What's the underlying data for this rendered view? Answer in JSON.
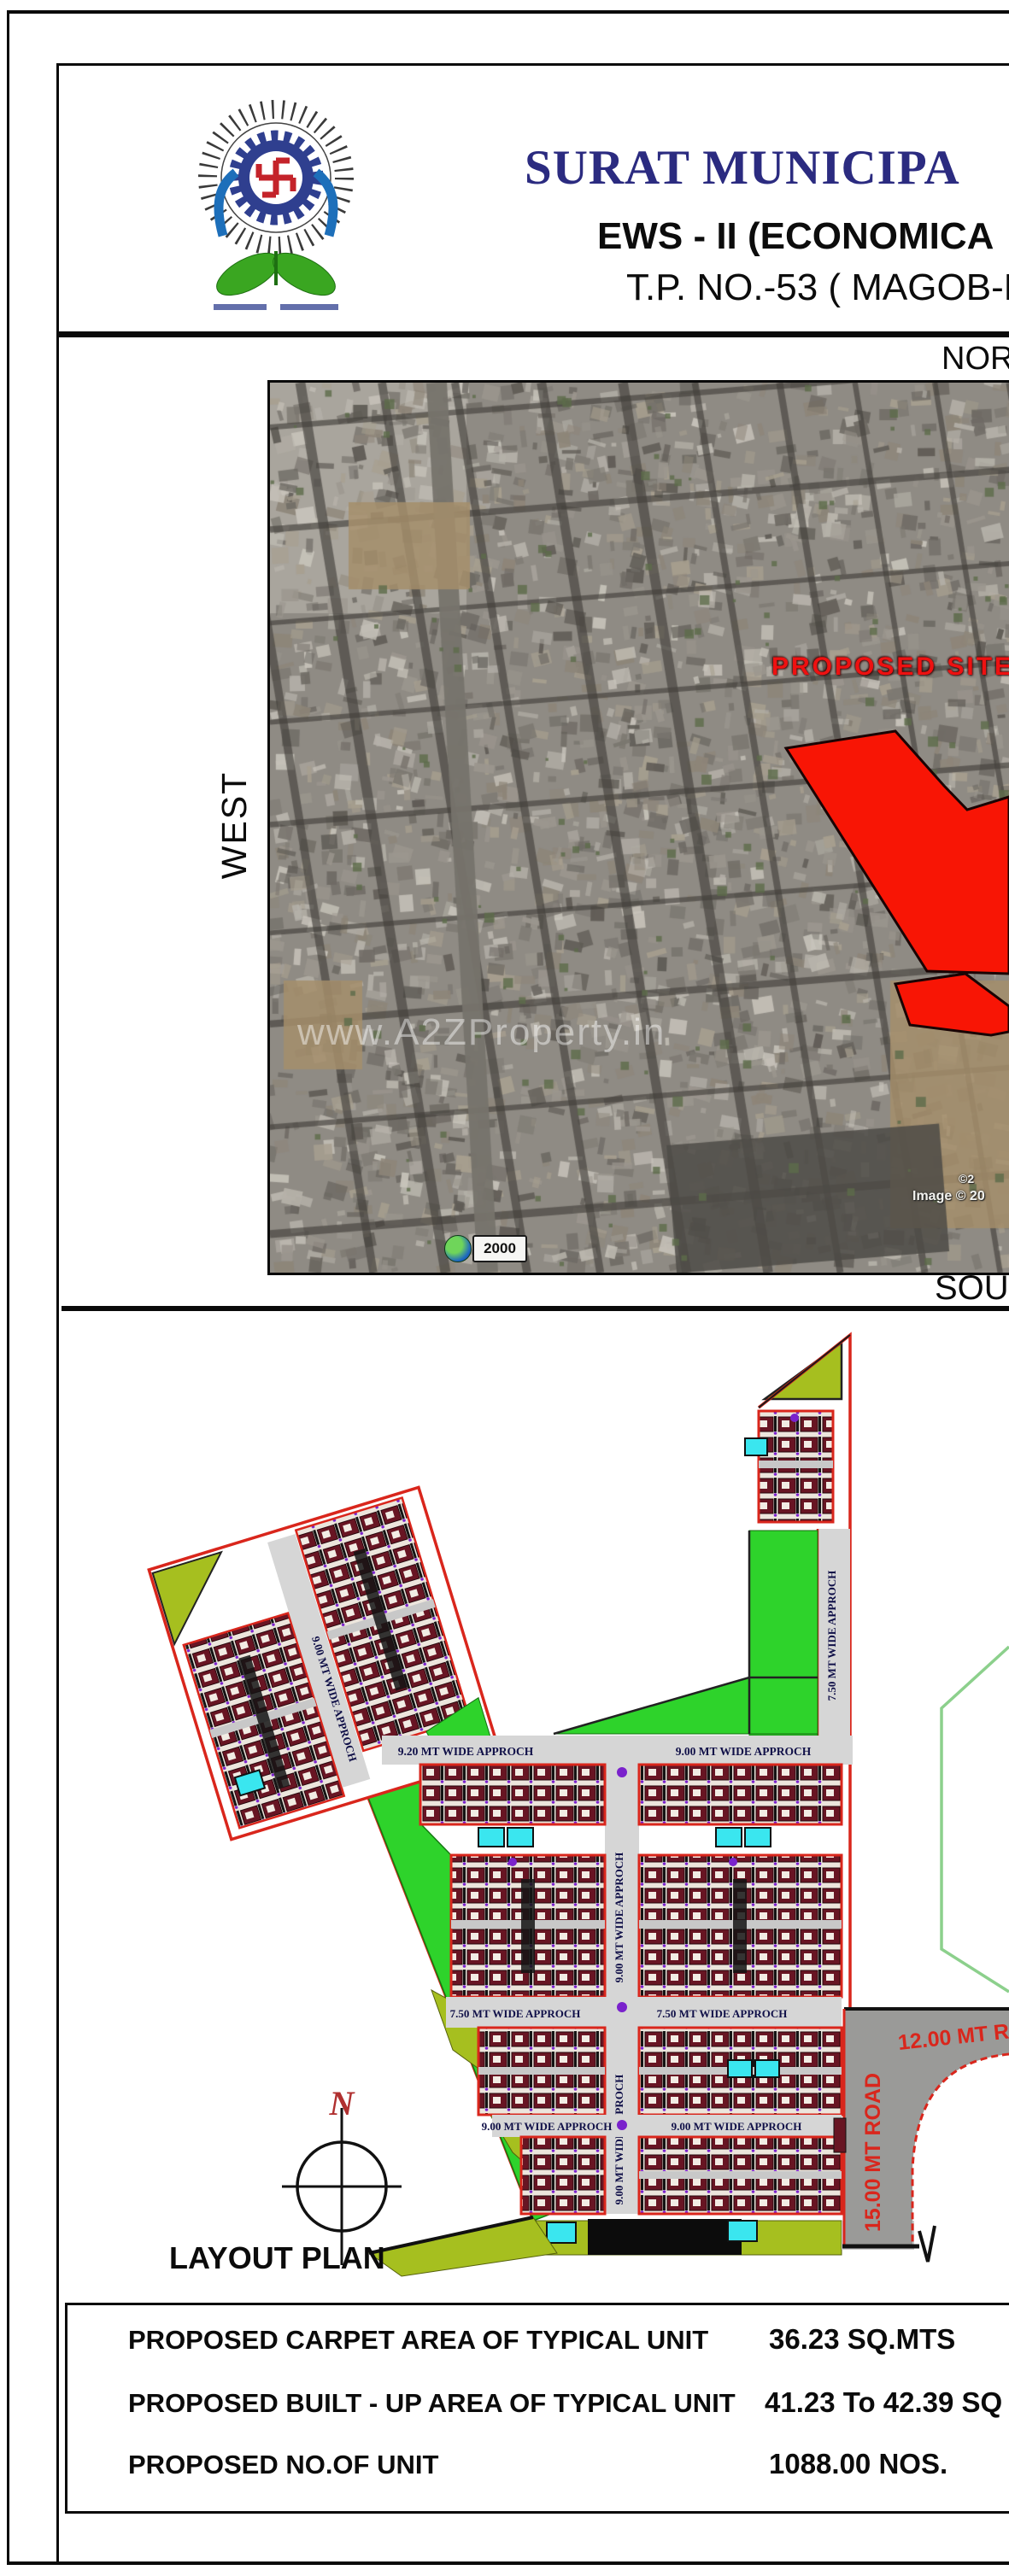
{
  "header": {
    "logo": "surat-municipal-corporation-emblem",
    "title_line1": "SURAT MUNICIPA",
    "title_line2": "EWS - II (ECONOMICA",
    "title_line3": "T.P. NO.-53 ( MAGOB-D"
  },
  "directions": {
    "north": "NORTH",
    "west": "WEST",
    "south": "SOUTH"
  },
  "map": {
    "proposed_site_label": "PROPOSED SITE",
    "watermark": "www.A2ZProperty.in",
    "scale_badge": "2000",
    "copyright_line1": "©2",
    "copyright_line2": "Image © 20"
  },
  "layout_plan": {
    "title": "LAYOUT PLAN",
    "compass_label": "N",
    "roads": {
      "h1_left": "9.20 MT WIDE APPROCH",
      "h1_right": "9.00 MT WIDE APPROCH",
      "h2_left": "7.50 MT WIDE APPROCH",
      "h2_right": "7.50 MT WIDE APPROCH",
      "h3_left": "9.00 MT WIDE APPROCH",
      "h3_right": "9.00 MT WIDE APPROCH",
      "v_center_upper": "9.00 MT WIDE APPROCH",
      "v_center_lower": "9.00 MT WIDE APPROCH",
      "v_right": "7.50 MT WIDE APPROCH",
      "parcel": "9.00 MT WIDE APPROCH",
      "road_12": "12.00 MT ROAD",
      "road_15": "15.00 MT ROAD"
    }
  },
  "summary": {
    "rows": [
      {
        "label": "PROPOSED CARPET AREA OF TYPICAL UNIT",
        "value": "36.23 SQ.MTS"
      },
      {
        "label": "PROPOSED BUILT - UP  AREA OF TYPICAL UNIT",
        "value": "41.23 To 42.39 SQ"
      },
      {
        "label": "PROPOSED NO.OF UNIT",
        "value": "1088.00 NOS."
      }
    ]
  },
  "colors": {
    "accent_red": "#d9261c",
    "navy": "#2b2b80",
    "olive": "#a6bf1f",
    "green": "#2ed32b",
    "cyan": "#3ae6ef",
    "road_gray": "#d6d6d6"
  }
}
